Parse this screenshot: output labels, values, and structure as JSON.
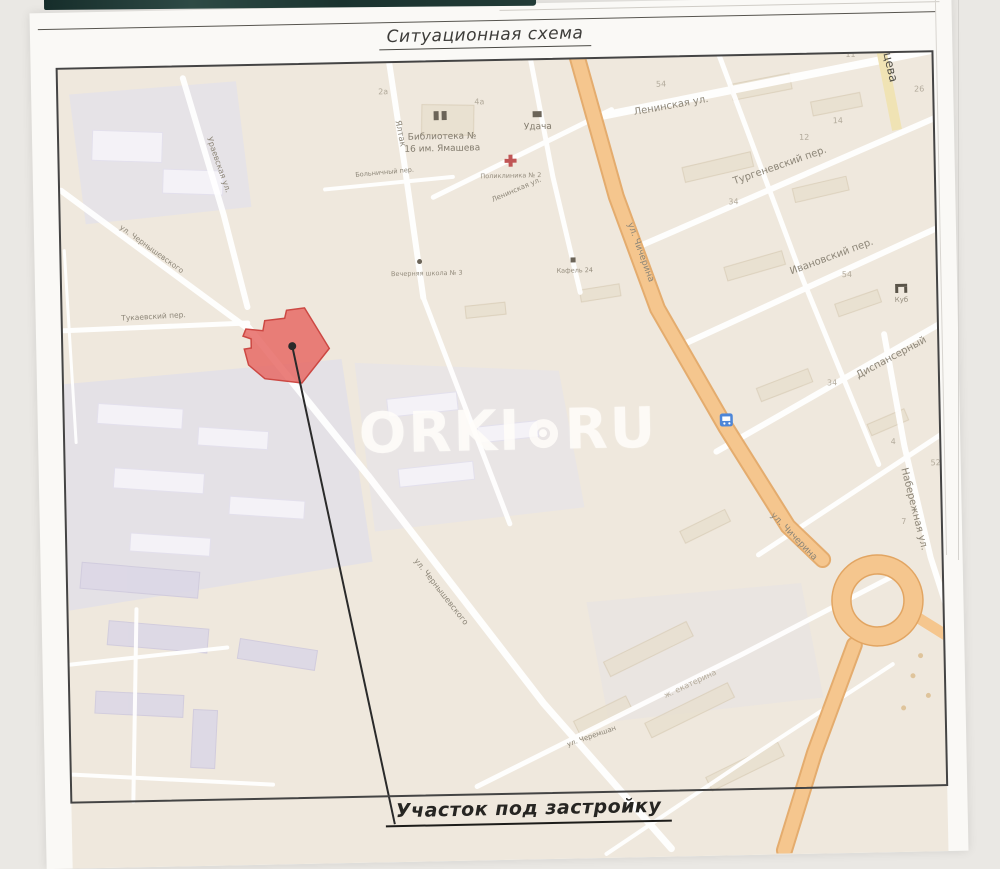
{
  "page": {
    "title": "Ситуационная схема",
    "caption": "Участок под застройку"
  },
  "watermark": {
    "left": "ORKI",
    "right": "RU"
  },
  "map": {
    "streets": [
      {
        "label": "Ленинская ул."
      },
      {
        "label": "Тургеневский пер."
      },
      {
        "label": "Ивановский пер."
      },
      {
        "label": "Диспансерный"
      },
      {
        "label": "Набережная ул."
      },
      {
        "label": "ул. Чичерина"
      },
      {
        "label": "ул. Чичерина"
      },
      {
        "label": "Ураевская ул."
      },
      {
        "label": "ул. Чернышевского"
      },
      {
        "label": "Тукаевский пер."
      },
      {
        "label": "Ялтак"
      },
      {
        "label": "Больничный пер."
      },
      {
        "label": "Ленинская ул."
      },
      {
        "label": "ул. Чернышевского"
      },
      {
        "label": "ул. Черемшан"
      },
      {
        "label": "цева"
      },
      {
        "label": "ж. екатерина"
      }
    ],
    "pois": [
      {
        "line1": "Библиотека №",
        "line2": "16 им. Ямашева"
      },
      {
        "label": "Удача"
      },
      {
        "label": "Поликлиника № 2"
      },
      {
        "label": "Вечерняя школа № 3"
      },
      {
        "label": "Кафель 24"
      },
      {
        "label": "Куб"
      }
    ],
    "house_numbers": [
      "4а",
      "11",
      "26",
      "54",
      "12",
      "14",
      "34",
      "54",
      "34",
      "4",
      "52",
      "7",
      "2а"
    ],
    "colors": {
      "plot_fill": "#E66A65",
      "plot_stroke": "#CC4843",
      "road_orange": "#F5C68E",
      "map_background": "#EFE8DD",
      "residential_zone": "#E2DFE9"
    }
  }
}
